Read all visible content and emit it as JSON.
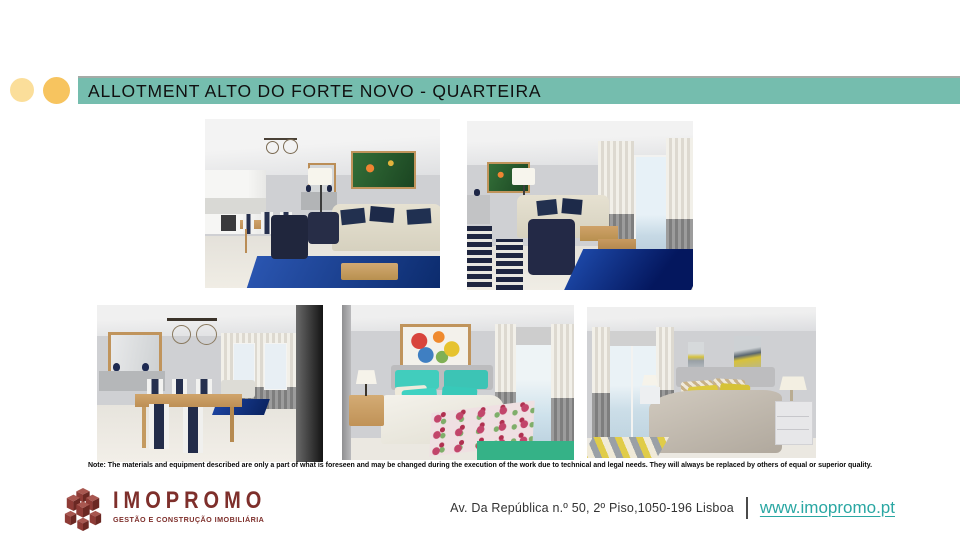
{
  "slide": {
    "title": "ALLOTMENT ALTO DO FORTE NOVO - QUARTEIRA",
    "colors": {
      "title_bar": "#75BDAE",
      "accent_circle_light": "#FBDE9A",
      "accent_circle_dark": "#F7C45F",
      "logo_maroon": "#7E2F2B",
      "website_teal": "#2AA7A3"
    }
  },
  "gallery": [
    {
      "label": "Render of open-plan living room with white kitchen, wood dining table, navy armchairs, cream sofa and blue rug"
    },
    {
      "label": "Render of living room with cream sofa, navy armchairs, blue rug and balcony window with grey and white curtains"
    },
    {
      "label": "Render of dining room with wood table, navy and white chairs, mirror, sideboard and wire chandeliers"
    },
    {
      "label": "Render of bedroom with turquoise pillows, floral bedspread, wood nightstands and green carpet"
    },
    {
      "label": "Render of bedroom with grey bed, yellow pillows, white nightstands and balcony window"
    }
  ],
  "note": {
    "text": "Note: The materials and equipment described are only a part of what is foreseen and may be changed during the execution of the work due to technical and legal needs. They will always be replaced by others of equal or superior quality."
  },
  "footer": {
    "brand": "IMOPROMO",
    "tagline": "GESTÃO E CONSTRUÇÃO IMOBILIÁRIA",
    "address": "Av. Da República n.º 50, 2º Piso,1050-196 Lisboa",
    "separator": "|",
    "website": "www.imopromo.pt"
  }
}
